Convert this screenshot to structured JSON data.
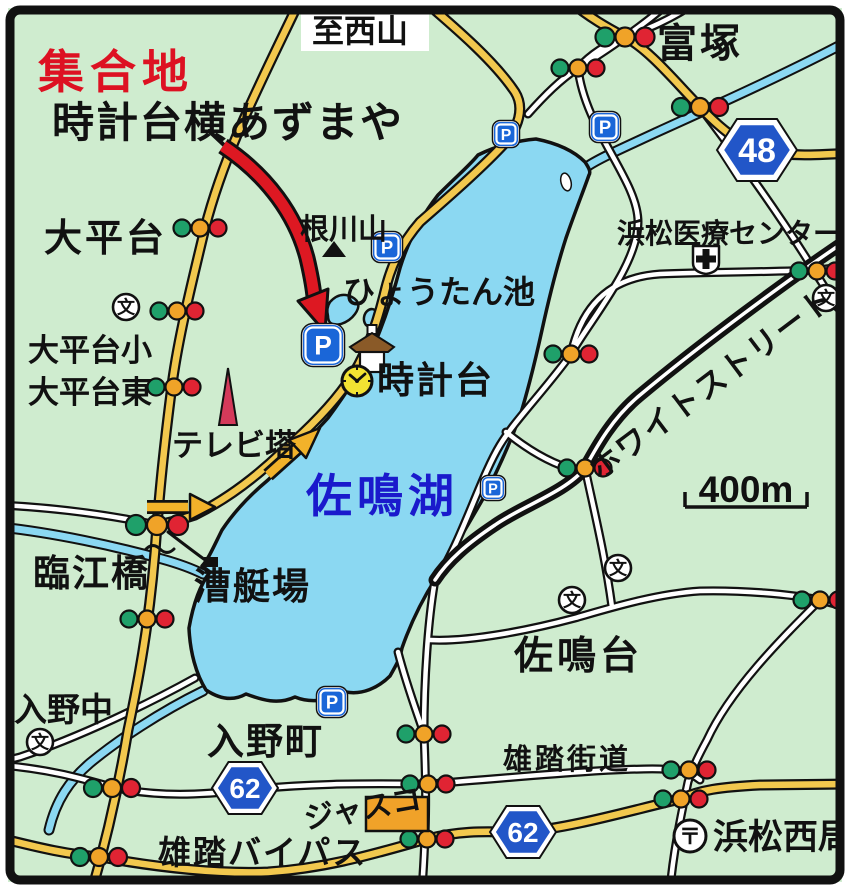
{
  "map_title": "佐鳴湖 集合地 案内図",
  "colors": {
    "bg": "#cfeccf",
    "ink": "#111111",
    "water": "#8bd8f2",
    "road_yellow": "#f2c84e",
    "road_white": "#ffffff",
    "red_text": "#dd1122",
    "blue_text": "#1a1acc",
    "arrow_red": "#dd1822",
    "arrow_yellow": "#f2b22a",
    "parking_blue": "#1a66d8",
    "badge_blue": "#2256c8",
    "light_green": "#1fa06a",
    "light_yellow": "#f0a328",
    "light_red": "#e02433",
    "tower_red": "#d43a5a",
    "store_orange": "#f0a229",
    "roof_brown": "#8a5a28",
    "clock_yellow": "#f2e232"
  },
  "map": {
    "rivers": [
      {
        "name": "river-northeast",
        "d": "M850,40 C790,72 710,108 655,133 C625,147 600,158 588,166"
      },
      {
        "name": "river-west",
        "d": "M0,527 C55,533 115,546 162,559 C180,564 195,570 203,574"
      },
      {
        "name": "river-south-outflow",
        "d": "M203,691 C160,712 118,740 90,763 C70,780 56,800 49,830"
      }
    ],
    "lake": {
      "name": "lake-sanaru",
      "d": "M478,155 C494,147 514,141 536,139 C556,143 573,150 585,162 C589,168 591,172 589,175 C583,192 575,212 566,238 C557,266 549,298 542,330 C535,362 528,390 520,416 C510,443 498,470 484,497 C468,525 452,552 436,578 C422,600 410,625 402,648 C400,658 398,662 390,676 C378,688 362,695 346,692 C330,700 312,704 295,697 C278,705 262,700 246,694 C232,702 218,698 206,690 C196,674 190,652 189,628 C193,605 200,585 210,572 L202,566 C208,560 214,546 222,530 C234,512 250,495 268,480 C288,460 308,440 328,418 C345,395 360,372 373,348 C384,322 393,295 400,268 C408,242 420,218 438,195 C458,175 470,165 478,155 Z"
    },
    "ponds": [
      {
        "name": "hyotan-pond-1",
        "d": "M330,302 q10,-11 22,-5 q11,6 3,17 q-5,7 -14,10 q-13,3 -13,-8 q-2,-8 2,-14 Z"
      },
      {
        "name": "hyotan-pond-2",
        "cx": 371,
        "cy": 318,
        "rx": 7,
        "ry": 9,
        "rot": 12
      }
    ],
    "island": {
      "name": "lake-island",
      "cx": 566,
      "cy": 182,
      "rx": 5,
      "ry": 9,
      "rot": -14
    },
    "road_styles": {
      "white": {
        "casing": 9,
        "fill": 4.5,
        "casing_color": "ink",
        "fill_color": "road_white"
      },
      "thick": {
        "casing": 13,
        "fill": 3.5,
        "casing_color": "ink",
        "fill_color": "road_white"
      },
      "yellow": {
        "casing": 11,
        "fill": 6.5,
        "casing_color": "ink",
        "fill_color": "road_yellow"
      }
    },
    "road_groups": [
      {
        "style": "white",
        "paths": [
          {
            "name": "road-tomitsuka-n",
            "d": "M672,0 C648,22 605,52 578,68 C560,80 545,95 528,114"
          },
          {
            "name": "road-tomitsuka-n2",
            "d": "M700,0 C670,20 648,29 625,37 C606,44 590,55 578,68"
          },
          {
            "name": "road-hospital-west",
            "d": "M578,68 C585,130 638,180 638,222 C638,265 590,320 571,354"
          },
          {
            "name": "road-lake-ne-east",
            "d": "M571,354 C583,300 615,277 660,274 C710,272 770,272 818,270 L850,266"
          },
          {
            "name": "road-48-south",
            "d": "M700,107 C740,160 780,215 815,272 L838,308"
          },
          {
            "name": "road-lake-east-shore",
            "d": "M571,354 C545,390 515,420 500,445 C480,478 460,545 436,580"
          },
          {
            "name": "road-shore-connector",
            "d": "M506,432 C528,450 550,462 568,468"
          },
          {
            "name": "road-sanarudai-n",
            "d": "M585,468 C595,515 605,555 612,607"
          },
          {
            "name": "road-sanarudai-e",
            "d": "M430,640 C470,642 530,630 575,618 C610,608 655,594 700,591 C740,590 790,594 820,600 L850,608"
          },
          {
            "name": "road-south-vertical",
            "d": "M435,580 C428,620 424,680 424,734 C426,784 427,820 422,890"
          },
          {
            "name": "road-lake-se",
            "d": "M398,652 C408,690 418,715 424,734"
          },
          {
            "name": "road-nishikyoku",
            "d": "M820,600 C780,640 730,690 707,740 C695,762 690,775 688,782 C680,820 673,855 670,890"
          },
          {
            "name": "road-yuto-kaido",
            "d": "M0,765 C60,770 95,783 116,788 C160,797 200,795 245,790 C320,782 380,784 428,784 C520,777 610,768 660,769 C680,770 690,772 700,780"
          },
          {
            "name": "road-lakeshore-south",
            "d": "M195,678 C150,703 80,737 20,757 L0,762"
          },
          {
            "name": "road-west-left",
            "d": "M0,505 C60,508 110,515 157,525"
          }
        ]
      },
      {
        "style": "thick",
        "paths": [
          {
            "name": "road-white-street",
            "d": "M850,238 C790,278 700,345 640,395 C612,418 596,448 585,468 C566,492 522,506 495,525 C468,543 448,560 435,580"
          }
        ]
      },
      {
        "style": "yellow",
        "paths": [
          {
            "name": "road-main-ns",
            "d": "M300,0 C262,80 225,150 205,228 C190,290 178,340 172,385 C163,455 160,490 157,525 C152,600 143,660 128,730 C118,790 105,845 92,890"
          },
          {
            "name": "road-tomitsuka-48",
            "d": "M568,0 C590,18 608,28 625,37 C650,50 678,85 700,107 C720,128 735,140 757,150 C790,157 820,155 850,153"
          },
          {
            "name": "road-lakeside",
            "d": "M423,0 C458,30 495,62 515,92 C525,108 518,128 505,143 C480,170 445,200 420,222 C400,245 390,268 384,295 C374,335 362,362 348,382 C330,408 305,432 282,452 C255,478 225,500 195,515 C180,520 168,523 157,525"
          },
          {
            "name": "road-yuto-bypass",
            "d": "M0,838 C40,848 70,855 101,857 C160,868 220,874 268,872 C330,868 380,852 427,839 C470,828 500,833 523,832 C570,828 625,812 680,799 C700,790 720,787 760,785 L850,784"
          }
        ]
      }
    ],
    "extras": [
      {
        "name": "boathouse-access-path",
        "d": "M168,532 C185,545 198,555 208,562",
        "w": 3,
        "c": "ink"
      },
      {
        "name": "bridge-squiggle",
        "d": "M146,549 q7,-7 14,0 q7,7 14,0",
        "w": 3,
        "c": "ink"
      },
      {
        "name": "red-arrow-tail-slash",
        "d": "M209,131 L241,161",
        "w": 4,
        "c": "ink"
      }
    ],
    "arrows": {
      "red": {
        "name": "meeting-point-arrow",
        "shaft": "M223,146 C268,176 296,216 307,258 C311,275 313,287 314,296",
        "head": "325,332 328,289 298,301",
        "casing": 17,
        "fill_w": 11
      },
      "yellow": [
        {
          "name": "route-arrow-ne",
          "shaft": "M268,475 L298,448",
          "head": "320,428 306,458 289,440"
        },
        {
          "name": "route-arrow-east",
          "shaft": "M147,507 L188,507",
          "head": "215,507 190,494 190,520"
        }
      ]
    },
    "badges": [
      {
        "name": "route-badge-48",
        "label": "48",
        "x": 757,
        "y": 150,
        "hw": 40,
        "hh": 31,
        "fs": 34
      },
      {
        "name": "route-badge-62-west",
        "label": "62",
        "x": 245,
        "y": 788,
        "hw": 33,
        "hh": 26,
        "fs": 28
      },
      {
        "name": "route-badge-62-east",
        "label": "62",
        "x": 523,
        "y": 832,
        "hw": 33,
        "hh": 26,
        "fs": 28
      }
    ],
    "traffic_lights": [
      {
        "x": 200,
        "y": 228,
        "r": 8.5
      },
      {
        "x": 177,
        "y": 311,
        "r": 8.5
      },
      {
        "x": 174,
        "y": 387,
        "r": 8.5
      },
      {
        "x": 157,
        "y": 525,
        "r": 10
      },
      {
        "x": 147,
        "y": 619,
        "r": 8.5
      },
      {
        "x": 112,
        "y": 788,
        "r": 9
      },
      {
        "x": 99,
        "y": 857,
        "r": 9
      },
      {
        "x": 625,
        "y": 37,
        "r": 9.5
      },
      {
        "x": 578,
        "y": 68,
        "r": 8.5
      },
      {
        "x": 700,
        "y": 107,
        "r": 9
      },
      {
        "x": 817,
        "y": 271,
        "r": 8.5
      },
      {
        "x": 571,
        "y": 354,
        "r": 8.5
      },
      {
        "x": 585,
        "y": 468,
        "r": 8.5
      },
      {
        "x": 820,
        "y": 600,
        "r": 8.5
      },
      {
        "x": 424,
        "y": 734,
        "r": 8.5
      },
      {
        "x": 428,
        "y": 784,
        "r": 8.5
      },
      {
        "x": 427,
        "y": 839,
        "r": 8.5
      },
      {
        "x": 689,
        "y": 770,
        "r": 8.5
      },
      {
        "x": 681,
        "y": 799,
        "r": 8.5
      }
    ],
    "parkings": [
      {
        "name": "parking-lake-north-1",
        "x": 506,
        "y": 134,
        "s": 24
      },
      {
        "name": "parking-lake-north-2",
        "x": 605,
        "y": 127,
        "s": 28
      },
      {
        "name": "parking-negawayama",
        "x": 387,
        "y": 247,
        "s": 28
      },
      {
        "name": "parking-meeting-point",
        "x": 323,
        "y": 345,
        "s": 40
      },
      {
        "name": "parking-east-shore",
        "x": 493,
        "y": 488,
        "s": 22
      },
      {
        "name": "parking-south",
        "x": 332,
        "y": 702,
        "s": 28
      }
    ],
    "schools": [
      {
        "name": "school-ohiradai-sho",
        "x": 126,
        "y": 307
      },
      {
        "name": "school-east-edge",
        "x": 826,
        "y": 298
      },
      {
        "name": "school-sanarudai-1",
        "x": 618,
        "y": 568
      },
      {
        "name": "school-sanarudai-2",
        "x": 572,
        "y": 600
      },
      {
        "name": "school-irino-naka",
        "x": 40,
        "y": 742
      }
    ],
    "school_glyph": "文",
    "icons": {
      "hospital": {
        "name": "hospital-icon",
        "x": 706,
        "y": 258
      },
      "post_office": {
        "name": "post-office-icon",
        "x": 690,
        "y": 836,
        "glyph": "〒"
      },
      "clock": {
        "name": "clock-tower-icon",
        "x": 357,
        "y": 381,
        "r": 15
      },
      "gazebo": {
        "name": "gazebo-icon",
        "x": 372,
        "y": 352
      },
      "mountain": {
        "name": "mountain-peak-icon",
        "x": 334,
        "y": 250
      },
      "tv_tower": {
        "name": "tv-tower-icon",
        "pts": "228,368 219,425 237,425"
      },
      "store": {
        "name": "jusco-store-icon",
        "x": 366,
        "y": 797,
        "w": 62,
        "h": 34
      },
      "dock": {
        "name": "boathouse-dock-icon",
        "x": 204,
        "y": 557,
        "w": 14,
        "h": 10
      }
    },
    "scale": {
      "name": "scale-bar",
      "label": "400m",
      "x1": 685,
      "x2": 807,
      "y": 507,
      "tick": 15,
      "fs": 37
    },
    "labels": [
      {
        "n": "label-meeting-point",
        "t": "集合地",
        "x": 38,
        "y": 88,
        "s": 46,
        "c": "red_text",
        "ls": 6
      },
      {
        "n": "label-meeting-place",
        "t": "時計台横あずまや",
        "x": 52,
        "y": 137,
        "s": 42,
        "c": "ink",
        "ls": 2
      },
      {
        "n": "label-to-nishiyama",
        "t": "至西山",
        "x": 312,
        "y": 42,
        "s": 32,
        "c": "ink",
        "bg": [
          301,
          9,
          128,
          42
        ]
      },
      {
        "n": "label-tomitsuka",
        "t": "富塚",
        "x": 657,
        "y": 57,
        "s": 40,
        "c": "ink",
        "ls": 3
      },
      {
        "n": "label-ohiradai",
        "t": "大平台",
        "x": 44,
        "y": 251,
        "s": 38,
        "c": "ink",
        "ls": 3
      },
      {
        "n": "label-ohiradai-sho",
        "t": "大平台小",
        "x": 28,
        "y": 361,
        "s": 31,
        "c": "ink"
      },
      {
        "n": "label-ohiradai-higashi",
        "t": "大平台東",
        "x": 28,
        "y": 403,
        "s": 31,
        "c": "ink"
      },
      {
        "n": "label-negawayama",
        "t": "根川山",
        "x": 300,
        "y": 239,
        "s": 29,
        "c": "ink"
      },
      {
        "n": "label-hyotan-ike",
        "t": "ひょうたん池",
        "x": 343,
        "y": 303,
        "s": 32,
        "c": "ink"
      },
      {
        "n": "label-tokeidai",
        "t": "時計台",
        "x": 377,
        "y": 393,
        "s": 37,
        "c": "ink",
        "ls": 2
      },
      {
        "n": "label-medical-center",
        "t": "浜松医療センター",
        "x": 617,
        "y": 243,
        "s": 28,
        "c": "ink"
      },
      {
        "n": "label-white-street",
        "t": "ホワイトストリート",
        "x": 718,
        "y": 392,
        "s": 31,
        "c": "ink",
        "ls": 2,
        "rot": -37,
        "anchor": "middle"
      },
      {
        "n": "label-sanaruko",
        "t": "佐鳴湖",
        "x": 306,
        "y": 512,
        "s": 46,
        "c": "blue_text",
        "ls": 5
      },
      {
        "n": "label-tv-tower",
        "t": "テレビ塔",
        "x": 172,
        "y": 456,
        "s": 31,
        "c": "ink"
      },
      {
        "n": "label-rinkobashi",
        "t": "臨江橋",
        "x": 33,
        "y": 586,
        "s": 37,
        "c": "ink",
        "ls": 2
      },
      {
        "n": "label-soteijo",
        "t": "漕艇場",
        "x": 194,
        "y": 599,
        "s": 37,
        "c": "ink",
        "ls": 2
      },
      {
        "n": "label-sanarudai",
        "t": "佐鳴台",
        "x": 514,
        "y": 669,
        "s": 39,
        "c": "ink",
        "ls": 4
      },
      {
        "n": "label-irino-naka",
        "t": "入野中",
        "x": 14,
        "y": 721,
        "s": 33,
        "c": "ink"
      },
      {
        "n": "label-irino-cho",
        "t": "入野町",
        "x": 207,
        "y": 754,
        "s": 37,
        "c": "ink",
        "ls": 2
      },
      {
        "n": "label-yuto-kaido",
        "t": "雄踏街道",
        "x": 503,
        "y": 769,
        "s": 29,
        "c": "ink",
        "ls": 3
      },
      {
        "n": "label-yuto-bypass",
        "t": "雄踏バイパス",
        "x": 158,
        "y": 864,
        "s": 33,
        "c": "ink",
        "ls": 2
      },
      {
        "n": "label-hamamatsu-nishi",
        "t": "浜松西局",
        "x": 713,
        "y": 849,
        "s": 35,
        "c": "ink"
      },
      {
        "n": "label-jusco",
        "t": "ジャスコ",
        "x": 306,
        "y": 829,
        "s": 30,
        "c": "ink",
        "rot": -10
      }
    ]
  }
}
